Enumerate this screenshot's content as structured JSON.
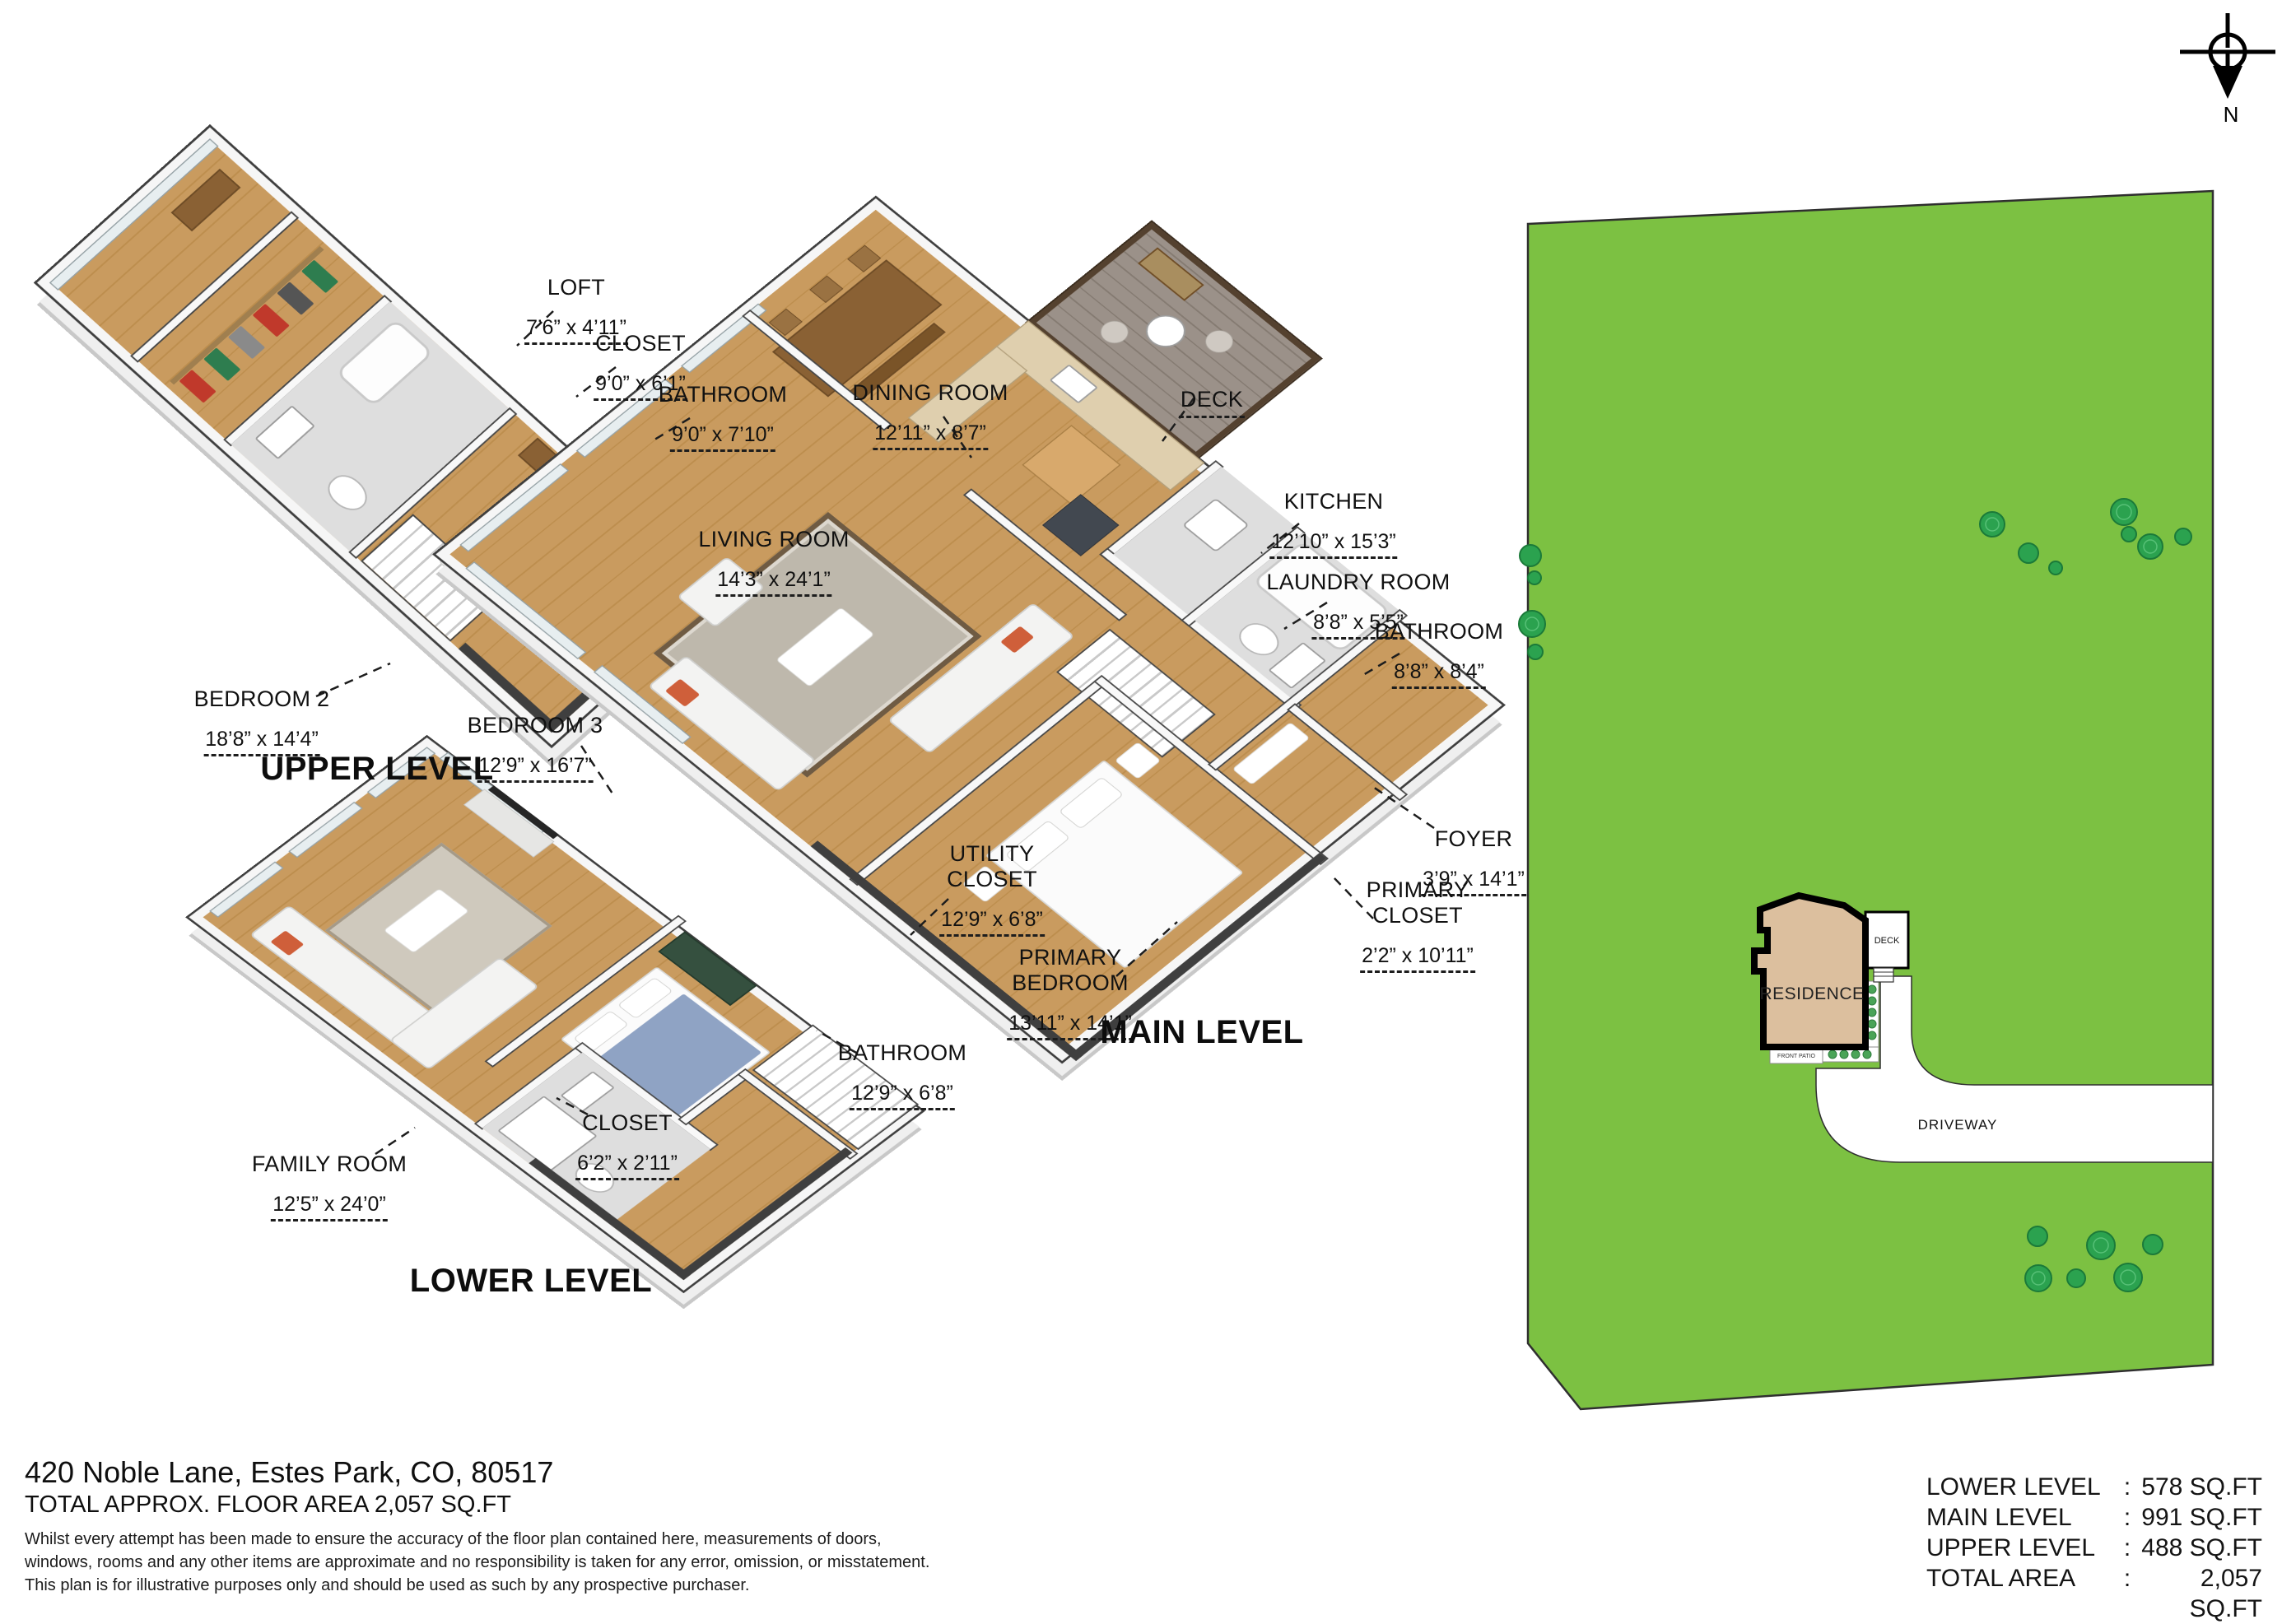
{
  "meta": {
    "address": "420 Noble Lane, Estes Park, CO, 80517",
    "total_line": "TOTAL APPROX. FLOOR AREA 2,057 SQ.FT",
    "disclaimer": "Whilst every attempt has been made to ensure the accuracy of the floor plan contained here, measurements of doors,\nwindows, rooms and any other items are approximate and no responsibility is taken for any error, omission, or misstatement.\nThis plan is for illustrative purposes only and should be used as such by any prospective purchaser."
  },
  "levels": {
    "upper": {
      "title": "UPPER LEVEL"
    },
    "main": {
      "title": "MAIN LEVEL"
    },
    "lower": {
      "title": "LOWER LEVEL"
    }
  },
  "rooms": {
    "loft": {
      "name": "LOFT",
      "dims": "7’6” x 4’11”"
    },
    "closet_upper": {
      "name": "CLOSET",
      "dims": "9’0” x 6’1”"
    },
    "bathroom_upper": {
      "name": "BATHROOM",
      "dims": "9’0” x 7’10”"
    },
    "bedroom2": {
      "name": "BEDROOM 2",
      "dims": "18’8” x 14’4”"
    },
    "bedroom3": {
      "name": "BEDROOM 3",
      "dims": "12’9” x 16’7”"
    },
    "dining": {
      "name": "DINING ROOM",
      "dims": "12’11” x 8’7”"
    },
    "deck": {
      "name": "DECK",
      "dims": ""
    },
    "kitchen": {
      "name": "KITCHEN",
      "dims": "12’10” x 15’3”"
    },
    "laundry": {
      "name": "LAUNDRY ROOM",
      "dims": "8’8” x 5’5”"
    },
    "bathroom_main": {
      "name": "BATHROOM",
      "dims": "8’8” x 8’4”"
    },
    "living": {
      "name": "LIVING ROOM",
      "dims": "14’3” x 24’1”"
    },
    "foyer": {
      "name": "FOYER",
      "dims": "3’9” x 14’1”"
    },
    "primary_closet": {
      "name": "PRIMARY\nCLOSET",
      "dims": "2’2” x 10’11”"
    },
    "primary_bedroom": {
      "name": "PRIMARY\nBEDROOM",
      "dims": "13’11” x 14’1”"
    },
    "utility_closet": {
      "name": "UTILITY\nCLOSET",
      "dims": "12’9” x 6’8”"
    },
    "bathroom_lower": {
      "name": "BATHROOM",
      "dims": "12’9” x 6’8”"
    },
    "closet_lower": {
      "name": "CLOSET",
      "dims": "6’2” x 2’11”"
    },
    "family": {
      "name": "FAMILY ROOM",
      "dims": "12’5” x 24’0”"
    }
  },
  "areas": {
    "colon": ":",
    "rows": [
      {
        "label": "LOWER LEVEL",
        "value": "578 SQ.FT"
      },
      {
        "label": "MAIN LEVEL",
        "value": "991 SQ.FT"
      },
      {
        "label": "UPPER LEVEL",
        "value": "488 SQ.FT"
      },
      {
        "label": "TOTAL AREA",
        "value": "2,057 SQ.FT"
      }
    ]
  },
  "site": {
    "residence": "RESIDENCE",
    "deck": "DECK",
    "driveway": "DRIVEWAY",
    "front_patio": "FRONT PATIO",
    "compass_n": "N"
  },
  "colors": {
    "lot_green": "#7cc142",
    "tree_green": "#2ba24f",
    "residence_tan": "#dcbf9e",
    "floor_wood": "#c99b5f",
    "wall_dark": "#3e3e3e"
  }
}
